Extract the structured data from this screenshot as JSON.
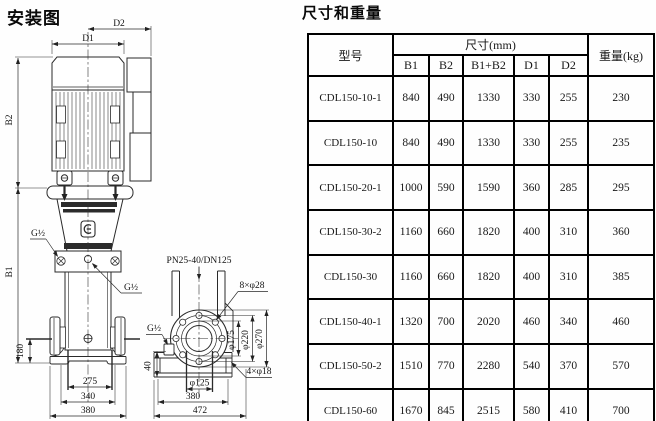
{
  "diagram": {
    "title": "安装图",
    "labels": {
      "d1": "D1",
      "d2": "D2",
      "b1": "B1",
      "b2": "B2",
      "g_thread": "G½",
      "flange_spec": "PN25-40/DN125",
      "flange_bolts": "8×φ28",
      "base_bolts": "4×φ18"
    },
    "dims": {
      "d180": "180",
      "d275": "275",
      "d340": "340",
      "d380": "380",
      "d40": "40",
      "d472": "472",
      "dia125": "φ125",
      "dia175": "φ175",
      "dia220": "φ220",
      "dia270": "φ270"
    }
  },
  "table": {
    "title": "尺寸和重量",
    "header": {
      "model": "型号",
      "size_group": "尺寸(mm)",
      "size_cols": [
        "B1",
        "B2",
        "B1+B2",
        "D1",
        "D2"
      ],
      "weight": "重量(kg)"
    },
    "rows": [
      {
        "model": "CDL150-10-1",
        "b1": "840",
        "b2": "490",
        "b1b2": "1330",
        "d1": "330",
        "d2": "255",
        "weight": "230"
      },
      {
        "model": "CDL150-10",
        "b1": "840",
        "b2": "490",
        "b1b2": "1330",
        "d1": "330",
        "d2": "255",
        "weight": "235"
      },
      {
        "model": "CDL150-20-1",
        "b1": "1000",
        "b2": "590",
        "b1b2": "1590",
        "d1": "360",
        "d2": "285",
        "weight": "295"
      },
      {
        "model": "CDL150-30-2",
        "b1": "1160",
        "b2": "660",
        "b1b2": "1820",
        "d1": "400",
        "d2": "310",
        "weight": "360"
      },
      {
        "model": "CDL150-30",
        "b1": "1160",
        "b2": "660",
        "b1b2": "1820",
        "d1": "400",
        "d2": "310",
        "weight": "385"
      },
      {
        "model": "CDL150-40-1",
        "b1": "1320",
        "b2": "700",
        "b1b2": "2020",
        "d1": "460",
        "d2": "340",
        "weight": "460"
      },
      {
        "model": "CDL150-50-2",
        "b1": "1510",
        "b2": "770",
        "b1b2": "2280",
        "d1": "540",
        "d2": "370",
        "weight": "570"
      },
      {
        "model": "CDL150-60",
        "b1": "1670",
        "b2": "845",
        "b1b2": "2515",
        "d1": "580",
        "d2": "410",
        "weight": "700"
      }
    ]
  }
}
